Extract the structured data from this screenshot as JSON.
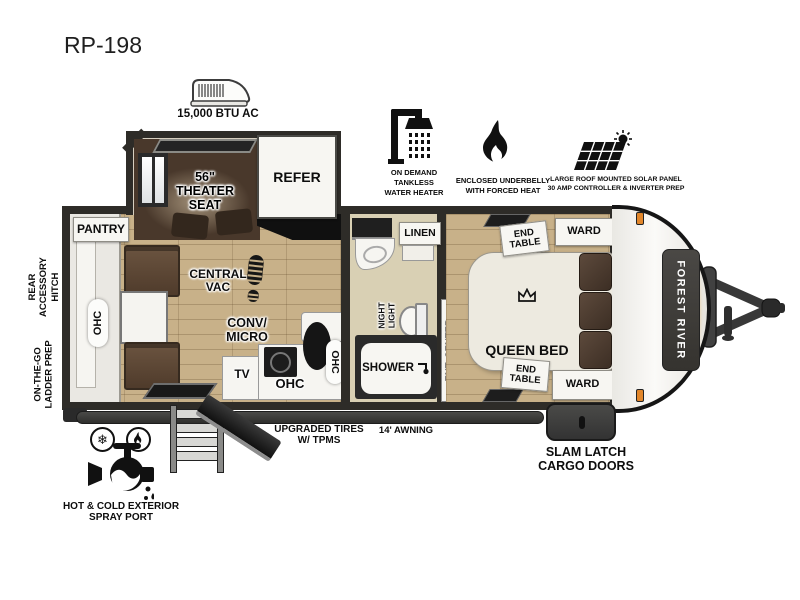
{
  "model": "RP-198",
  "brand": "FOREST RIVER",
  "roof_ac": "15,000 BTU AC",
  "features": {
    "water_heater": "ON DEMAND\nTANKLESS\nWATER HEATER",
    "underbelly": "ENCLOSED UNDERBELLY\nWITH FORCED HEAT",
    "solar": "LARGE ROOF MOUNTED SOLAR PANEL\n30 AMP CONTROLLER & INVERTER PREP"
  },
  "exterior": {
    "rear_accessory_hitch": "REAR\nACCESSORY\nHITCH",
    "ladder_prep": "ON-THE-GO\nLADDER PREP",
    "tires": "UPGRADED TIRES\nW/ TPMS",
    "awning": "14' AWNING",
    "cargo_doors": "SLAM LATCH\nCARGO DOORS",
    "spray_port": "HOT & COLD EXTERIOR\nSPRAY PORT"
  },
  "interior": {
    "pantry": "PANTRY",
    "rear_ohc": "OHC",
    "theater_seat": "56\"\nTHEATER\nSEAT",
    "refer": "REFER",
    "central_vac": "CENTRAL\nVAC",
    "conv_micro": "CONV/\nMICRO",
    "tv": "TV",
    "kitchen_ohc": "OHC",
    "kitchen_ohc_upper": "OHC",
    "linen": "LINEN",
    "night_light": "NIGHT\nLIGHT",
    "shower": "SHOWER",
    "ent_center": "ENT. CENTER",
    "queen_bed": "QUEEN BED",
    "end_table_top": "END\nTABLE",
    "end_table_bottom": "END\nTABLE",
    "ward_top": "WARD",
    "ward_bottom": "WARD"
  },
  "colors": {
    "wall": "#2e2c28",
    "floor": "#c8b189",
    "slide_floor": "#d6cebf",
    "theater_room": "#49382b",
    "bench_brown": "#5a4636",
    "pillow_brown": "#4e3d33",
    "fixture_white": "#f7f6f2",
    "awning_dark": "#3a3a38",
    "brand_orange": "#e8a33d"
  }
}
